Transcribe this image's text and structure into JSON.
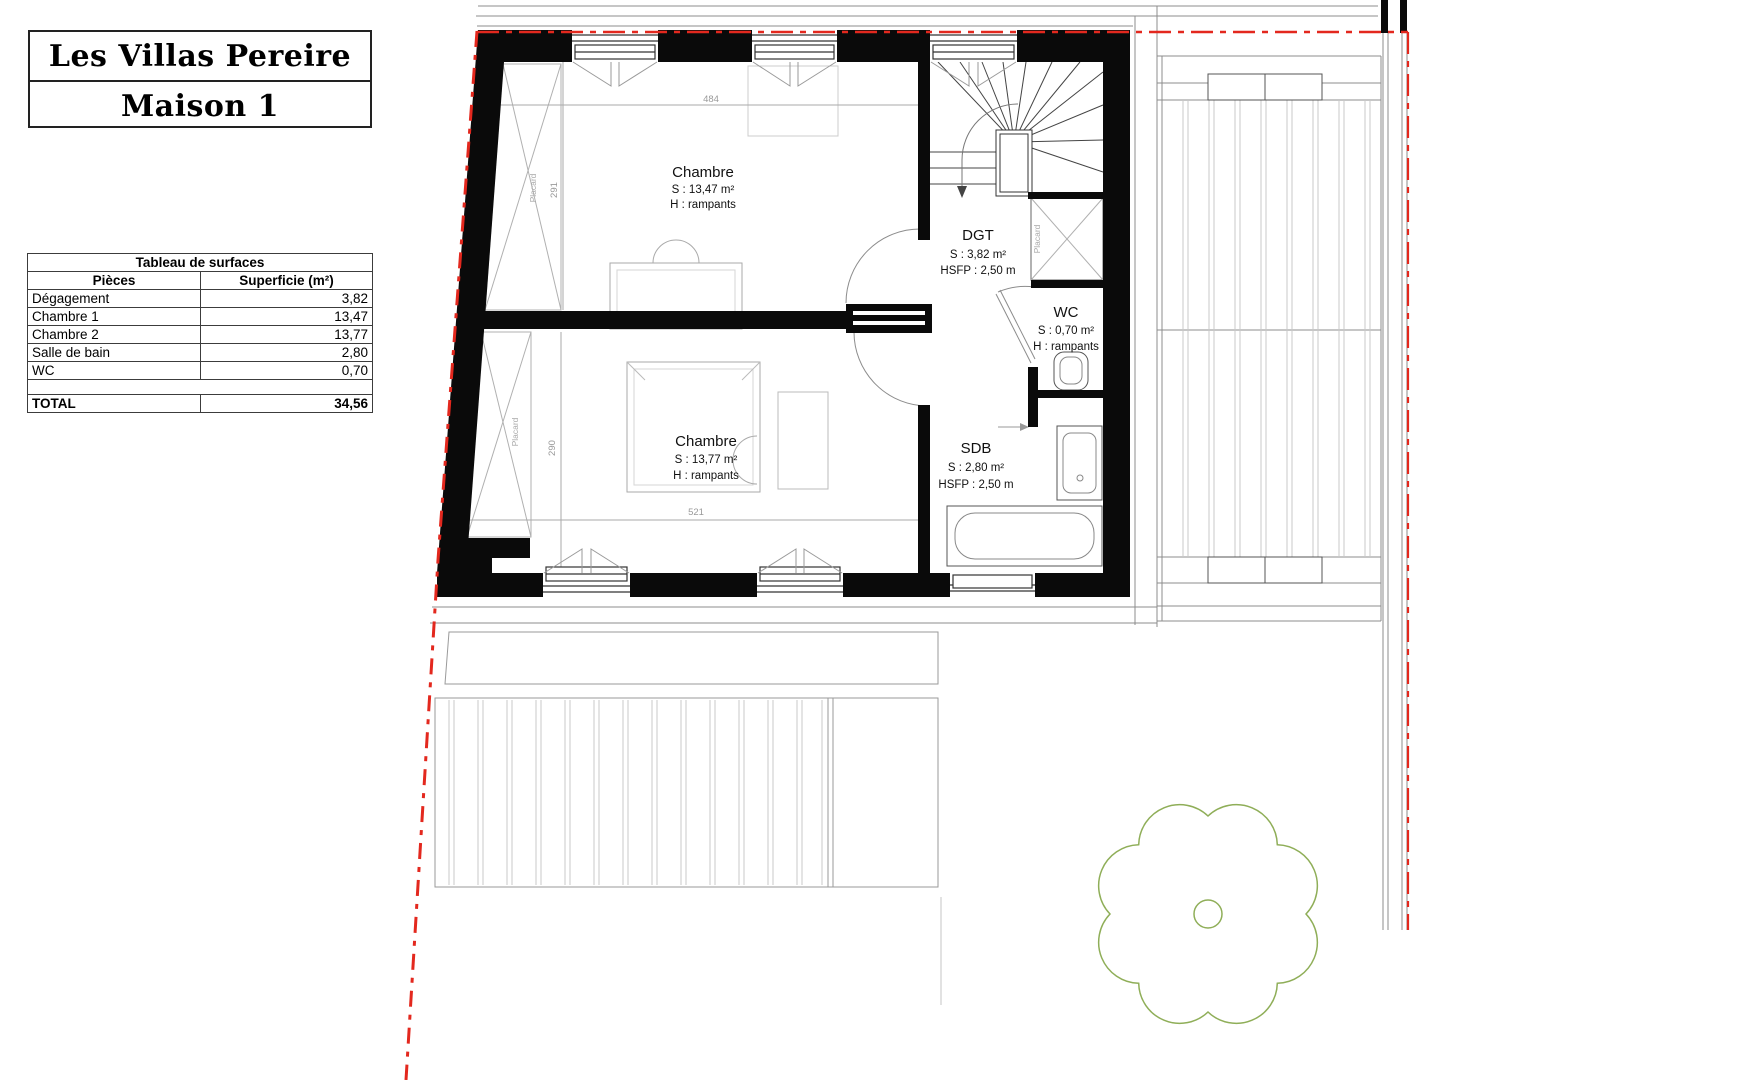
{
  "title_block": {
    "line1": "Les Villas Pereire",
    "line2": "Maison 1"
  },
  "surface_table": {
    "title": "Tableau de surfaces",
    "col_piece": "Pièces",
    "col_area": "Superficie (m²)",
    "rows": [
      {
        "label": "Dégagement",
        "value": "3,82"
      },
      {
        "label": "Chambre 1",
        "value": "13,47"
      },
      {
        "label": "Chambre 2",
        "value": "13,77"
      },
      {
        "label": "Salle de bain",
        "value": "2,80"
      },
      {
        "label": "WC",
        "value": "0,70"
      }
    ],
    "total_label": "TOTAL",
    "total_value": "34,56"
  },
  "rooms": {
    "chambre1": {
      "name": "Chambre",
      "area": "S : 13,47 m²",
      "height": "H : rampants"
    },
    "chambre2": {
      "name": "Chambre",
      "area": "S : 13,77 m²",
      "height": "H : rampants"
    },
    "dgt": {
      "name": "DGT",
      "area": "S : 3,82 m²",
      "height": "HSFP : 2,50 m"
    },
    "wc": {
      "name": "WC",
      "area": "S : 0,70 m²",
      "height": "H : rampants"
    },
    "sdb": {
      "name": "SDB",
      "area": "S : 2,80 m²",
      "height": "HSFP : 2,50 m"
    }
  },
  "dimensions": {
    "chambre1_width": "484",
    "chambre1_depth": "291",
    "chambre2_width": "521",
    "chambre2_depth": "290",
    "placard1": "Placard",
    "placard2": "Placard",
    "placard3": "Placard"
  },
  "colors": {
    "wall": "#0a0a0a",
    "red_dash": "#e3281e",
    "tree": "#8fae58",
    "thin": "#8c8c8c"
  }
}
